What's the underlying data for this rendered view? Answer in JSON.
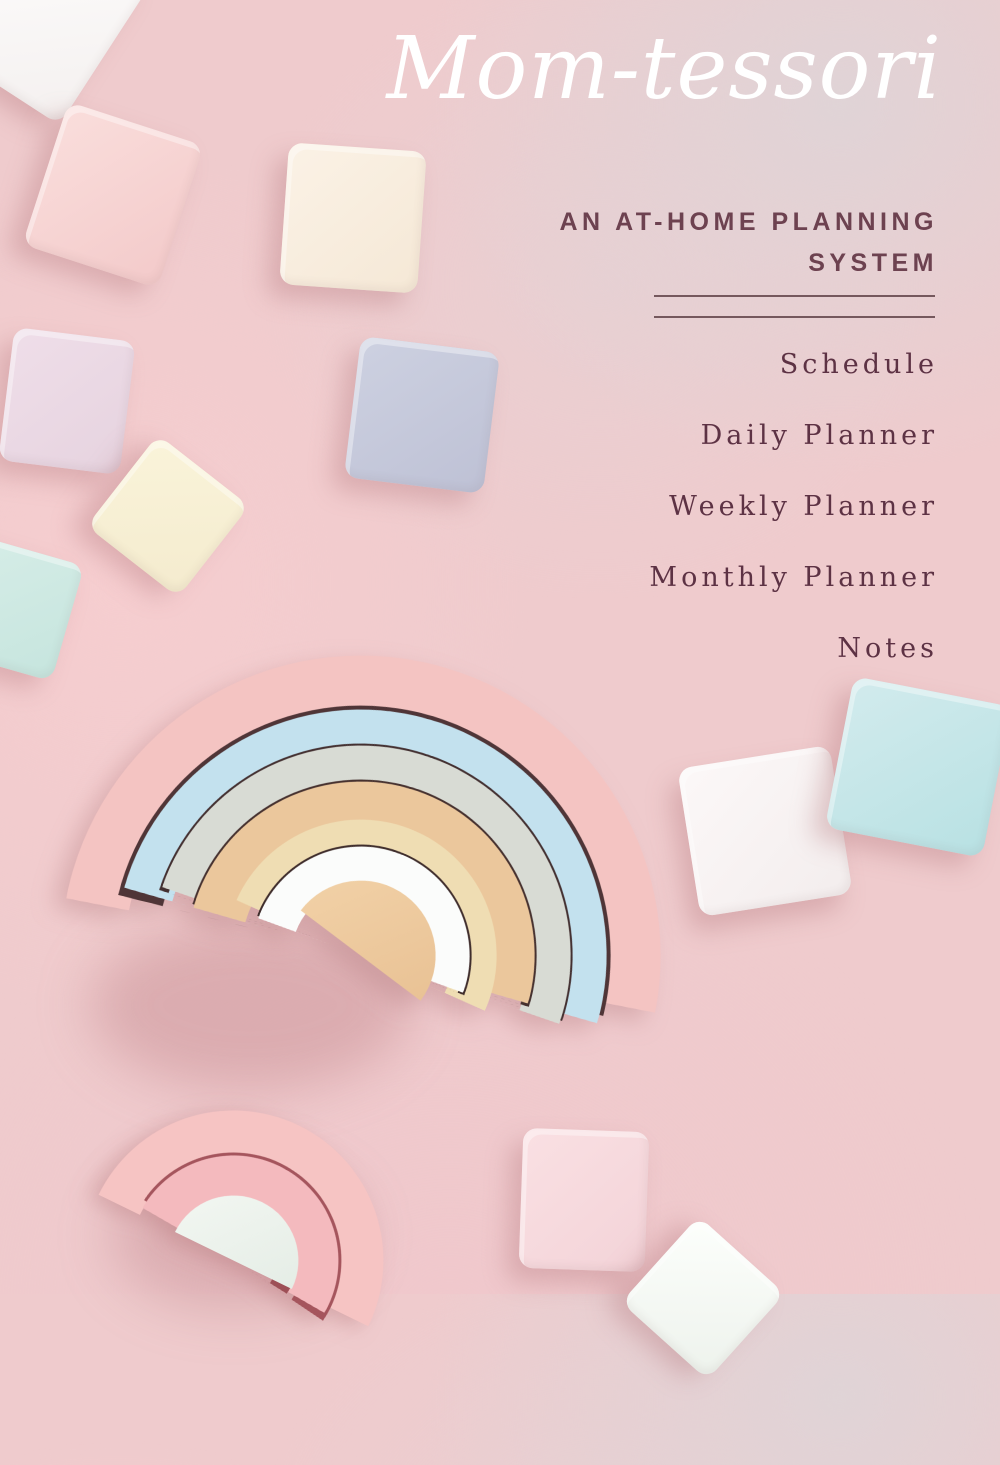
{
  "cover": {
    "title": "Mom-tessori",
    "subtitle": "AN AT-HOME PLANNING SYSTEM",
    "contents": [
      "Schedule",
      "Daily Planner",
      "Weekly Planner",
      "Monthly Planner",
      "Notes"
    ],
    "colors": {
      "background_pink": "#efcbcd",
      "accent_plum": "#5d3244",
      "title_white": "#ffffff"
    }
  }
}
